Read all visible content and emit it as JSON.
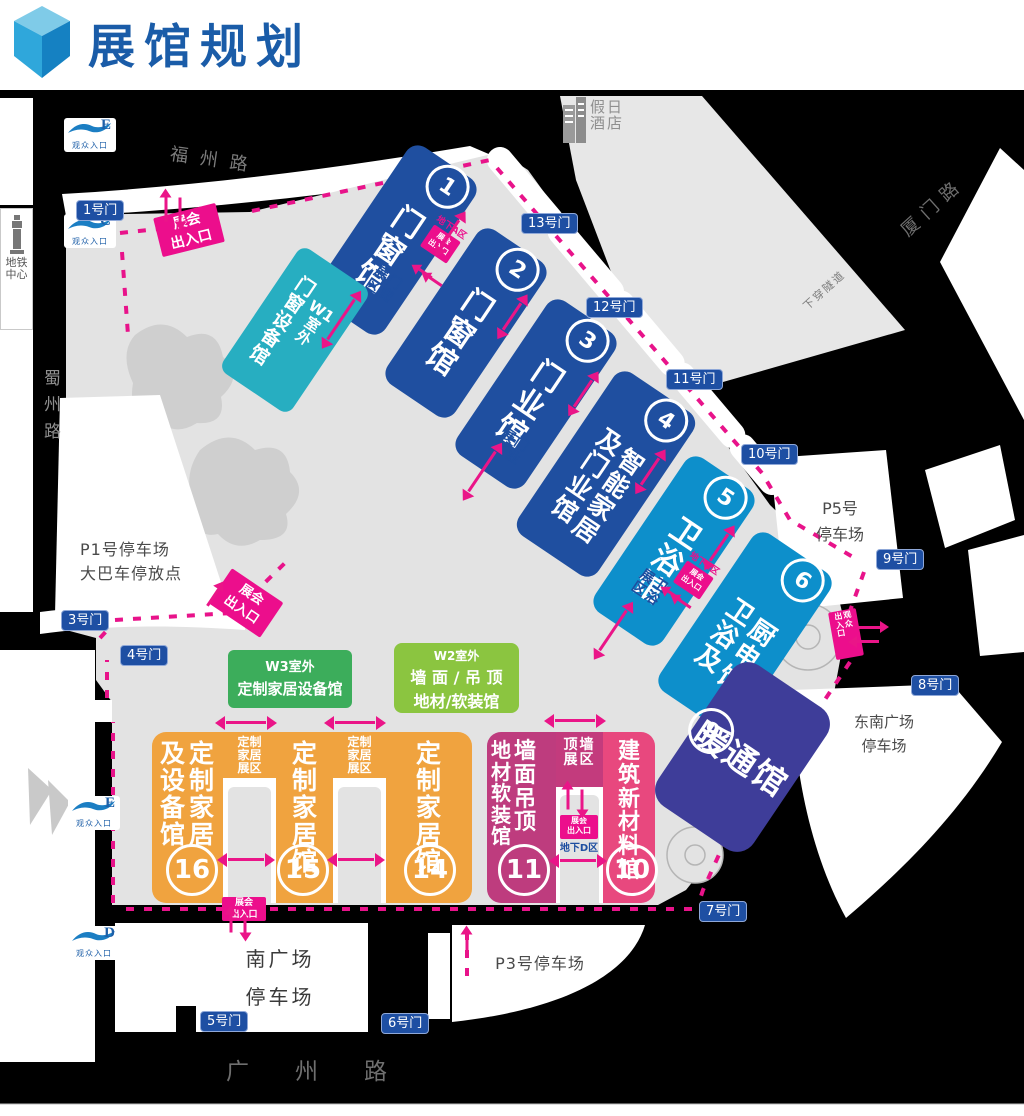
{
  "header": {
    "title": "展馆规划"
  },
  "roads": {
    "fuzhou": "福州路",
    "xiamen": "厦门路",
    "tunnel": "下穿隧道",
    "shuzhou": [
      "蜀",
      "州",
      "路"
    ],
    "guangzhou": "广州路"
  },
  "landmarks": {
    "hotel": [
      "假日",
      "酒店"
    ],
    "metro": [
      "地铁",
      "中心"
    ]
  },
  "gates": {
    "g1": "1号门",
    "g3": "3号门",
    "g4": "4号门",
    "g5": "5号门",
    "g6": "6号门",
    "g7": "7号门",
    "g8": "8号门",
    "g9": "9号门",
    "g10": "10号门",
    "g11": "11号门",
    "g12": "12号门",
    "g13": "13号门"
  },
  "entrances": {
    "label": "观众入口",
    "e_top": "E",
    "c": "C",
    "e_mid": "E",
    "d": "D"
  },
  "halls": {
    "h1": {
      "no": "1",
      "name": "门窗馆",
      "col": [
        "门",
        "窗",
        "馆"
      ]
    },
    "h2": {
      "no": "2",
      "name": "门窗馆",
      "col": [
        "门",
        "窗",
        "馆"
      ]
    },
    "h3": {
      "no": "3",
      "name": "门业馆",
      "col": [
        "门",
        "业",
        "馆"
      ]
    },
    "h4": {
      "no": "4",
      "name": "智能家居及门业馆",
      "col_left": [
        "及",
        "门",
        "业",
        "馆"
      ],
      "col_right": [
        "智",
        "能",
        "家",
        "居"
      ]
    },
    "h5": {
      "no": "5",
      "name": "卫浴馆",
      "col": [
        "卫",
        "浴",
        "馆"
      ]
    },
    "h6": {
      "no": "6",
      "name": "厨电及卫浴馆",
      "col_left": [
        "卫",
        "浴",
        "及"
      ],
      "col_right": [
        "厨",
        "电",
        "馆"
      ]
    },
    "h9": {
      "no": "9",
      "name": "暖通馆"
    },
    "h10": {
      "no": "10",
      "name": "建筑新材料馆",
      "col": [
        "建",
        "筑",
        "新",
        "材",
        "料",
        "馆"
      ]
    },
    "h11": {
      "no": "11",
      "name": "墙面吊顶地材软装馆",
      "col_left": [
        "地",
        "材",
        "软",
        "装",
        "馆"
      ],
      "col_right": [
        "墙",
        "面",
        "吊",
        "顶"
      ]
    },
    "h14": {
      "no": "14",
      "name": "定制家居馆",
      "col": [
        "定",
        "制",
        "家",
        "居",
        "馆"
      ]
    },
    "h15": {
      "no": "15",
      "name": "定制家居馆",
      "col": [
        "定",
        "制",
        "家",
        "居",
        "馆"
      ]
    },
    "h16": {
      "no": "16",
      "name": "定制家居及设备馆",
      "col_left": [
        "及",
        "设",
        "备",
        "馆"
      ],
      "col_right": [
        "定",
        "制",
        "家",
        "居"
      ]
    }
  },
  "outdoor": {
    "w1": {
      "code": [
        "W1",
        "室",
        "外"
      ],
      "name": [
        "门",
        "窗",
        "设",
        "备",
        "馆"
      ]
    },
    "w2": {
      "code": "W2室外",
      "line1": "墙 面 / 吊 顶",
      "line2": "地材/软装馆"
    },
    "w3": {
      "code": "W3室外",
      "name": "定制家居设备馆"
    }
  },
  "zones": {
    "mc": {
      "a": [
        "门",
        "窗"
      ],
      "b": [
        "展",
        "区"
      ]
    },
    "my": {
      "a": [
        "门",
        "业"
      ],
      "b": [
        "展",
        "区"
      ]
    },
    "wy": {
      "a": [
        "卫",
        "浴"
      ],
      "b": [
        "展",
        "区"
      ]
    },
    "dz": [
      "定制",
      "家居",
      "展区"
    ],
    "dq": [
      "顶墙",
      "展区"
    ]
  },
  "parking": {
    "p1": [
      "P1号停车场",
      "大巴车停放点"
    ],
    "p5": [
      "P5号",
      "停车场"
    ],
    "p3": "P3号停车场",
    "south": [
      "南广场",
      "停车场"
    ],
    "southeast": [
      "东南广场",
      "停车场"
    ]
  },
  "markers": {
    "expo": [
      "展会",
      "出入口"
    ],
    "visitor_a": [
      "观",
      "众"
    ],
    "visitor_b": [
      "出",
      "入",
      "口"
    ],
    "ua": "地下A区",
    "uc": "地下C区",
    "ud": "地下D区"
  },
  "colors": {
    "title_blue": "#1A5CA8",
    "hall_blue": "#1F4FA0",
    "hall_lightblue": "#0D8FCB",
    "hall_indigo": "#3E3D99",
    "hall_pink_dark": "#BE3C7E",
    "hall_pink": "#E8487E",
    "hall_orange": "#F0A33F",
    "w1_teal": "#27AEC1",
    "w2_green": "#8BC540",
    "w3_green": "#3CAD5B",
    "magenta": "#EC0E8C",
    "road_black": "#000000",
    "ground_gray": "#E3E3E3"
  }
}
